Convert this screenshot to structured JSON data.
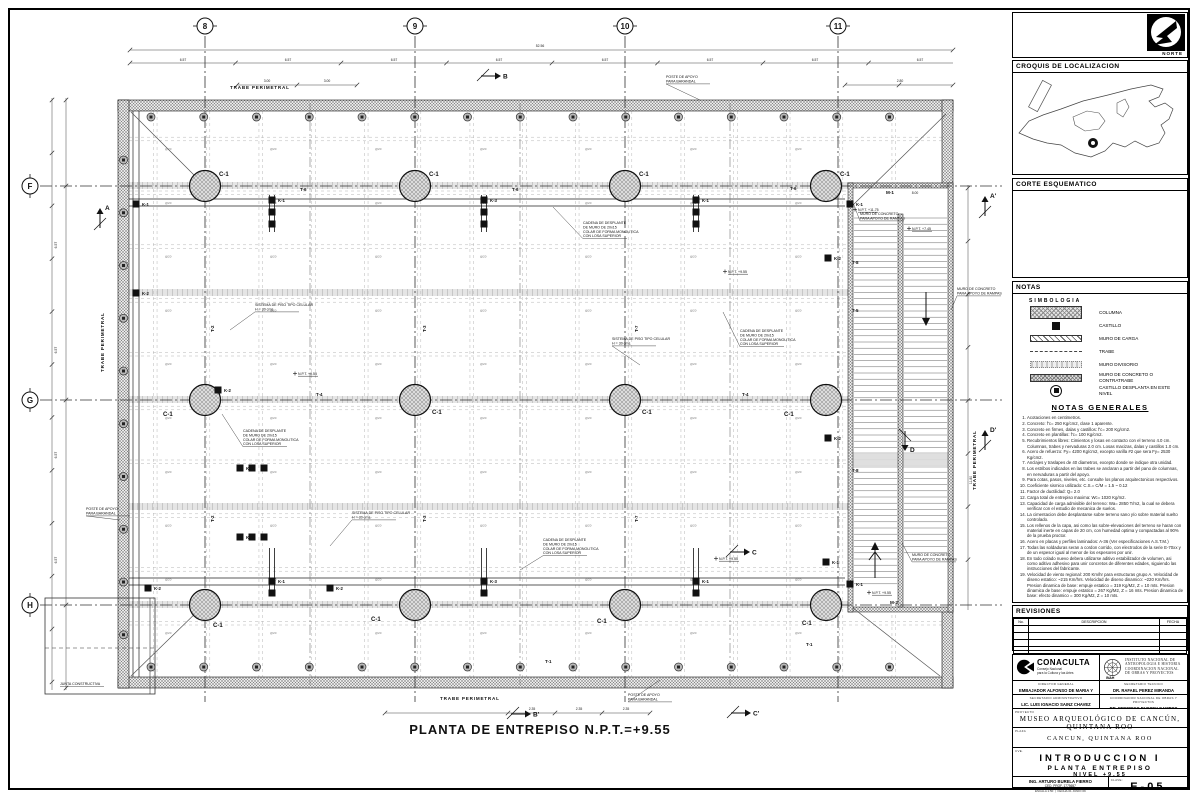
{
  "sheet": {
    "plan_title": "PLANTA DE ENTREPISO N.P.T.=+9.55"
  },
  "grid": {
    "top": [
      {
        "label": "8",
        "x": 205
      },
      {
        "label": "9",
        "x": 415
      },
      {
        "label": "10",
        "x": 625
      },
      {
        "label": "11",
        "x": 838
      }
    ],
    "left": [
      {
        "label": "F",
        "y": 186
      },
      {
        "label": "G",
        "y": 400
      },
      {
        "label": "H",
        "y": 605
      }
    ]
  },
  "plan": {
    "column_label": "C-1",
    "rebar_mark": "@20",
    "columns": [
      {
        "x": 205,
        "y": 186,
        "dx": 14,
        "dy": -10
      },
      {
        "x": 415,
        "y": 186,
        "dx": 14,
        "dy": -10
      },
      {
        "x": 625,
        "y": 186,
        "dx": 14,
        "dy": -10
      },
      {
        "x": 826,
        "y": 186,
        "dx": 14,
        "dy": -10
      },
      {
        "x": 205,
        "y": 400,
        "dx": -42,
        "dy": 16
      },
      {
        "x": 415,
        "y": 400,
        "dx": 17,
        "dy": 14
      },
      {
        "x": 625,
        "y": 400,
        "dx": 17,
        "dy": 14
      },
      {
        "x": 826,
        "y": 400,
        "dx": -42,
        "dy": 16
      },
      {
        "x": 205,
        "y": 605,
        "dx": 8,
        "dy": 22
      },
      {
        "x": 415,
        "y": 605,
        "dx": -44,
        "dy": 16
      },
      {
        "x": 625,
        "y": 605,
        "dx": -28,
        "dy": 18
      },
      {
        "x": 826,
        "y": 605,
        "dx": -24,
        "dy": 20
      }
    ],
    "castillos": [
      {
        "x": 136,
        "y": 204,
        "label": "K-1"
      },
      {
        "x": 136,
        "y": 293,
        "label": "K-2"
      },
      {
        "x": 272,
        "y": 200,
        "label": "K-1",
        "n": 3,
        "dir": "v"
      },
      {
        "x": 484,
        "y": 200,
        "label": "K-3",
        "n": 3,
        "dir": "v"
      },
      {
        "x": 696,
        "y": 200,
        "label": "K-1",
        "n": 3,
        "dir": "v"
      },
      {
        "x": 850,
        "y": 204,
        "label": "K-1"
      },
      {
        "x": 218,
        "y": 390,
        "label": "K-2"
      },
      {
        "x": 828,
        "y": 258,
        "label": "K-2"
      },
      {
        "x": 828,
        "y": 438,
        "label": "K-2"
      },
      {
        "x": 240,
        "y": 468,
        "label": "K-1",
        "n": 3,
        "dir": "h"
      },
      {
        "x": 240,
        "y": 537,
        "label": "K-1",
        "n": 3,
        "dir": "h"
      },
      {
        "x": 272,
        "y": 581,
        "label": "K-1",
        "n": 2,
        "dir": "v"
      },
      {
        "x": 484,
        "y": 581,
        "label": "K-3",
        "n": 2,
        "dir": "v"
      },
      {
        "x": 696,
        "y": 581,
        "label": "K-1",
        "n": 2,
        "dir": "v"
      },
      {
        "x": 148,
        "y": 588,
        "label": "K-2"
      },
      {
        "x": 330,
        "y": 588,
        "label": "K-2"
      },
      {
        "x": 850,
        "y": 584,
        "label": "K-1"
      },
      {
        "x": 826,
        "y": 562,
        "label": "K-1"
      }
    ],
    "beam_labels": [
      {
        "x": 300,
        "y": 191,
        "t": "T-6"
      },
      {
        "x": 512,
        "y": 191,
        "t": "T-6"
      },
      {
        "x": 790,
        "y": 190,
        "t": "T-6"
      },
      {
        "x": 852,
        "y": 264,
        "t": "T-8"
      },
      {
        "x": 852,
        "y": 472,
        "t": "T-8"
      },
      {
        "x": 852,
        "y": 312,
        "t": "T-5"
      },
      {
        "x": 316,
        "y": 396,
        "t": "T-4"
      },
      {
        "x": 742,
        "y": 396,
        "t": "T-4"
      },
      {
        "x": 214,
        "y": 332,
        "t": "T-2",
        "r": -90
      },
      {
        "x": 426,
        "y": 332,
        "t": "T-3",
        "r": -90
      },
      {
        "x": 638,
        "y": 332,
        "t": "T-7",
        "r": -90
      },
      {
        "x": 214,
        "y": 522,
        "t": "T-2",
        "r": -90
      },
      {
        "x": 426,
        "y": 522,
        "t": "T-3",
        "r": -90
      },
      {
        "x": 638,
        "y": 522,
        "t": "T-7",
        "r": -90
      },
      {
        "x": 806,
        "y": 646,
        "t": "T-1"
      },
      {
        "x": 545,
        "y": 663,
        "t": "T-1"
      }
    ],
    "dim_labels": [
      {
        "x": 540,
        "y": 47,
        "t": "52.56"
      },
      {
        "x": 183,
        "y": 61,
        "t": "6.57"
      },
      {
        "x": 288,
        "y": 61,
        "t": "6.57"
      },
      {
        "x": 394,
        "y": 61,
        "t": "6.57"
      },
      {
        "x": 499,
        "y": 61,
        "t": "6.57"
      },
      {
        "x": 605,
        "y": 61,
        "t": "6.57"
      },
      {
        "x": 710,
        "y": 61,
        "t": "6.57"
      },
      {
        "x": 815,
        "y": 61,
        "t": "6.57"
      },
      {
        "x": 920,
        "y": 61,
        "t": "6.57"
      },
      {
        "x": 267,
        "y": 82,
        "t": "3.00"
      },
      {
        "x": 327,
        "y": 82,
        "t": "3.00"
      },
      {
        "x": 900,
        "y": 82,
        "t": "2.80"
      },
      {
        "x": 532,
        "y": 710,
        "t": "2.35"
      },
      {
        "x": 579,
        "y": 710,
        "t": "2.35"
      },
      {
        "x": 626,
        "y": 710,
        "t": "2.35"
      },
      {
        "x": 57,
        "y": 245,
        "t": "6.57",
        "r": -90
      },
      {
        "x": 57,
        "y": 350,
        "t": "6.57",
        "r": -90
      },
      {
        "x": 57,
        "y": 455,
        "t": "6.57",
        "r": -90
      },
      {
        "x": 57,
        "y": 560,
        "t": "6.57",
        "r": -90
      },
      {
        "x": 972,
        "y": 480,
        "t": "11.80",
        "r": -90
      },
      {
        "x": 915,
        "y": 194,
        "t": "8.00"
      }
    ],
    "perimeter_labels": [
      {
        "x": 230,
        "y": 89,
        "t": "TRABE PERIMETRAL"
      },
      {
        "x": 440,
        "y": 700,
        "t": "TRABE PERIMETRAL"
      },
      {
        "x": 104,
        "y": 372,
        "t": "TRABE PERIMETRAL",
        "r": -90
      },
      {
        "x": 976,
        "y": 490,
        "t": "TRABE PERIMETRAL",
        "r": -90
      }
    ],
    "ramp_labels": [
      {
        "x": 886,
        "y": 194,
        "t": "M-1"
      },
      {
        "x": 890,
        "y": 604,
        "t": "M-2"
      }
    ],
    "level_marks": [
      {
        "x": 728,
        "y": 273,
        "t": "N.P.T. +9.55"
      },
      {
        "x": 298,
        "y": 375,
        "t": "N.P.T. +9.55"
      },
      {
        "x": 719,
        "y": 560,
        "t": "N.P.T. +9.55"
      },
      {
        "x": 858,
        "y": 211,
        "t": "N.P.T. +11.75"
      },
      {
        "x": 912,
        "y": 230,
        "t": "N.P.T. +7.45"
      },
      {
        "x": 872,
        "y": 594,
        "t": "N.P.T. +9.55"
      }
    ],
    "annotations": [
      {
        "x": 583,
        "y": 224,
        "tx": 553,
        "ty": 207,
        "lines": [
          "CADENA DE DESPLANTE",
          "DE MURO DE 20x15",
          "COLAR DE FORMA MONOLITICA",
          "CON LOSA SUPERIOR"
        ]
      },
      {
        "x": 740,
        "y": 332,
        "tx": 723,
        "ty": 312,
        "lines": [
          "CADENA DE DESPLANTE",
          "DE MURO DE 20x15",
          "COLAR DE FORMA MONOLITICA",
          "CON LOSA SUPERIOR"
        ]
      },
      {
        "x": 243,
        "y": 432,
        "tx": 222,
        "ty": 414,
        "lines": [
          "CADENA DE DESPLANTE",
          "DE MURO DE 20x15",
          "COLAR DE FORMA MONOLITICA",
          "CON LOSA SUPERIOR"
        ]
      },
      {
        "x": 543,
        "y": 541,
        "tx": 520,
        "ty": 570,
        "lines": [
          "CADENA DE DESPLANTE",
          "DE MURO DE 20x15",
          "COLAR DE FORMA MONOLITICA",
          "CON LOSA SUPERIOR"
        ]
      },
      {
        "x": 255,
        "y": 306,
        "tx": 230,
        "ty": 330,
        "lines": [
          "SISTEMA DE PISO TIPO CELULAR",
          "H = 30 cms."
        ]
      },
      {
        "x": 612,
        "y": 340,
        "tx": 640,
        "ty": 365,
        "lines": [
          "SISTEMA DE PISO TIPO CELULAR",
          "H = 30 cms."
        ]
      },
      {
        "x": 352,
        "y": 514,
        "tx": 330,
        "ty": 546,
        "lines": [
          "SISTEMA DE PISO TIPO CELULAR",
          "H = 30 cms."
        ]
      },
      {
        "x": 860,
        "y": 215,
        "tx": 852,
        "ty": 200,
        "lines": [
          "MURO DE CONCRETO",
          "PARA APOYO DE RAMPAS"
        ]
      },
      {
        "x": 957,
        "y": 290,
        "tx": 951,
        "ty": 310,
        "lines": [
          "MURO DE CONCRETO",
          "PARA APOYO DE RAMPAS"
        ]
      },
      {
        "x": 912,
        "y": 556,
        "tx": 902,
        "ty": 543,
        "lines": [
          "MURO DE CONCRETO",
          "PARA APOYO DE RAMPAS"
        ]
      },
      {
        "x": 666,
        "y": 78,
        "tx": 700,
        "ty": 100,
        "lines": [
          "POSTE DE APOYO",
          "PARA BARANDAL"
        ]
      },
      {
        "x": 86,
        "y": 510,
        "tx": 120,
        "ty": 520,
        "lines": [
          "POSTE DE APOYO",
          "PARA BARANDAL"
        ]
      },
      {
        "x": 628,
        "y": 696,
        "tx": 660,
        "ty": 680,
        "lines": [
          "POSTE DE APOYO",
          "PARA BARANDAL"
        ]
      },
      {
        "x": 60,
        "y": 685,
        "lines": [
          "JUNTA CONSTRUCTIVA"
        ]
      }
    ],
    "section_markers": [
      {
        "x": 100,
        "y": 212,
        "label": "A",
        "dir": "up"
      },
      {
        "x": 985,
        "y": 200,
        "label": "A'",
        "dir": "up"
      },
      {
        "x": 497,
        "y": 76,
        "label": "B",
        "dir": "right"
      },
      {
        "x": 527,
        "y": 714,
        "label": "B'",
        "dir": "right"
      },
      {
        "x": 746,
        "y": 552,
        "label": "C",
        "dir": "right"
      },
      {
        "x": 747,
        "y": 713,
        "label": "C'",
        "dir": "right"
      },
      {
        "x": 905,
        "y": 447,
        "label": "D",
        "dir": "down"
      },
      {
        "x": 985,
        "y": 434,
        "label": "D'",
        "dir": "up"
      }
    ]
  },
  "side_panel": {
    "norte": "NORTE",
    "croquis_title": "CROQUIS DE LOCALIZACION",
    "corte_title": "CORTE ESQUEMATICO",
    "notas_title": "NOTAS",
    "simbologia_title": "SIMBOLOGIA",
    "legend": [
      {
        "symbol": "columna",
        "label": "COLUMNA"
      },
      {
        "symbol": "castillo",
        "label": "CASTILLO"
      },
      {
        "symbol": "muro-carga",
        "label": "MURO DE CARGA"
      },
      {
        "symbol": "trabe",
        "label": "TRABE"
      },
      {
        "symbol": "muro-divisorio",
        "label": "MURO DIVISORIO"
      },
      {
        "symbol": "muro-concreto",
        "label": "MURO DE CONCRETO O CONTRATRABE"
      },
      {
        "symbol": "castillo-desplanta",
        "label": "CASTILLO DESPLANTA EN ESTE NIVEL"
      }
    ],
    "notas_generales_title": "NOTAS GENERALES",
    "notes": [
      "Acotaciones en centimetros.",
      "Concreto: f'c= 250 Kg/cm2, clase 1 aparente.",
      "Concreto en firmes, dalas y castillos: f'c= 200 Kg/cm2.",
      "Concreto en plantillas: f'c= 100 Kg/cm2.",
      "Recubrimientos libres: Cimientos y losas en contacto con el terreno 4.0 cm. Columnas, trabes y nervaduras 2.0 cm. Losas macizas, dalas y castillos 1.0 cm.",
      "Acero de refuerzo: Fy= 4200 Kg/cm2, excepto varilla #2 que sera Fy= 2530 Kg/cm2.",
      "Anclajes y traslapes de 40 diametros, excepto donde se indique otra unidad.",
      "Los estribos indicados en las trabes se anclaran a partir del pano de columnas, en nervaduras a partir del apoyo.",
      "Para cotas, pasos, niveles, etc. consulte los planos arquitectonicos respectivos.",
      "Coeficiente sismico utilizado: C.S.= C/M = 1.5 ~ 0.12",
      "Factor de ductilidad: Q= 2.0",
      "Carga total de entrepiso maxima: Wc= 1020 Kg/m2.",
      "Capacidad de carga admisible del terreno: Wa= 2850 T/m2, la cual se debera verificar con el estudio de mecanica de suelos.",
      "La cimentacion debe desplantarse sobre terreno sano y/o sobre material suelto controlado.",
      "Los rellenos de la capa, asi como las sobre-elevaciones del terreno se haran con material inerte en capas de 20 cm, con humedad optima y compactadas al 90% de la prueba proctor.",
      "Acero en placas y perfiles laminados: A-36 (Ver especificaciones A.S.T.M.)",
      "Todas las soldaduras seran a cordon corrido, con electrodos de la serie E-70xx y de un espesor igual al menor de los espesores por unir.",
      "En todo colado nuevo debera utilizarse aditivo estabilizador de volumen, asi como aditivo adhesivo para unir concretos de diferentes edades, siguiendo las instrucciones del fabricante.",
      "Velocidad de viento regional: 200 Km/hr para estructuras grupo A. Velocidad de diseno estatico: ~215 Km/hrs. Velocidad de diseno dinamico: ~220 Km/hrs. Presion dinamica de base: empuje estatico = 319 Kg/M2, Z = 10 mts. Presion dinamica de base: empuje estatico = 267 Kg/M2, Z = 16 mts. Presion dinamica de base: efecto dinamico = 300 Kg/M2, Z = 10 mts."
    ],
    "revisiones_title": "REVISIONES",
    "revisiones_headers": [
      "No.",
      "DESCRIPCION",
      "FECHA"
    ]
  },
  "title_block": {
    "conaculta": "CONACULTA",
    "conaculta_sub1": "Consejo Nacional",
    "conaculta_sub2": "para la Cultura y las Artes",
    "inah_l1": "INSTITUTO NACIONAL DE",
    "inah_l2": "ANTROPOLOGIA E HISTORIA",
    "inah_l3": "COORDINACION NACIONAL",
    "inah_l4": "DE OBRAS Y PROYECTOS",
    "inah_abbr": "INAH",
    "roles": [
      {
        "title": "DIRECTOR GENERAL",
        "name": "EMBAJADOR ALFONSO DE MARIA Y CAMPOS"
      },
      {
        "title": "SECRETARIO TECNICO",
        "name": "DR. RAFAEL PEREZ MIRANDA"
      },
      {
        "title": "SECRETARIO ADMINISTRATIVO",
        "name": "LIC. LUIS IGNACIO SAINZ CHAVEZ"
      },
      {
        "title": "COORDINADOR NACIONAL DE OBRAS Y PROYECTOS",
        "name": "DR. FEDERICO BUSSEY CAMPOS"
      }
    ],
    "project_label": "PROYECTO",
    "project": "MUSEO ARQUEOLÓGICO DE CANCÚN, QUINTANA ROO",
    "plaza_label": "PLAZA",
    "plaza": "CANCUN, QUINTANA ROO",
    "cve_label": "CVE.",
    "title1": "INTRODUCCION I",
    "title2": "PLANTA ENTREPISO",
    "title3": "NIVEL +9.55",
    "author_label": "PROYECTO:",
    "author": "ING. ARTURO BURELA FIERRO",
    "author_reg": "CED. PROF. 1775657",
    "escala_label": "ESCALA",
    "escala": "1:50",
    "fecha_label": "FECHA",
    "fecha": "01 JUNIO 09",
    "sheet_label": "CLAVE:",
    "sheet_no": "E-05"
  }
}
